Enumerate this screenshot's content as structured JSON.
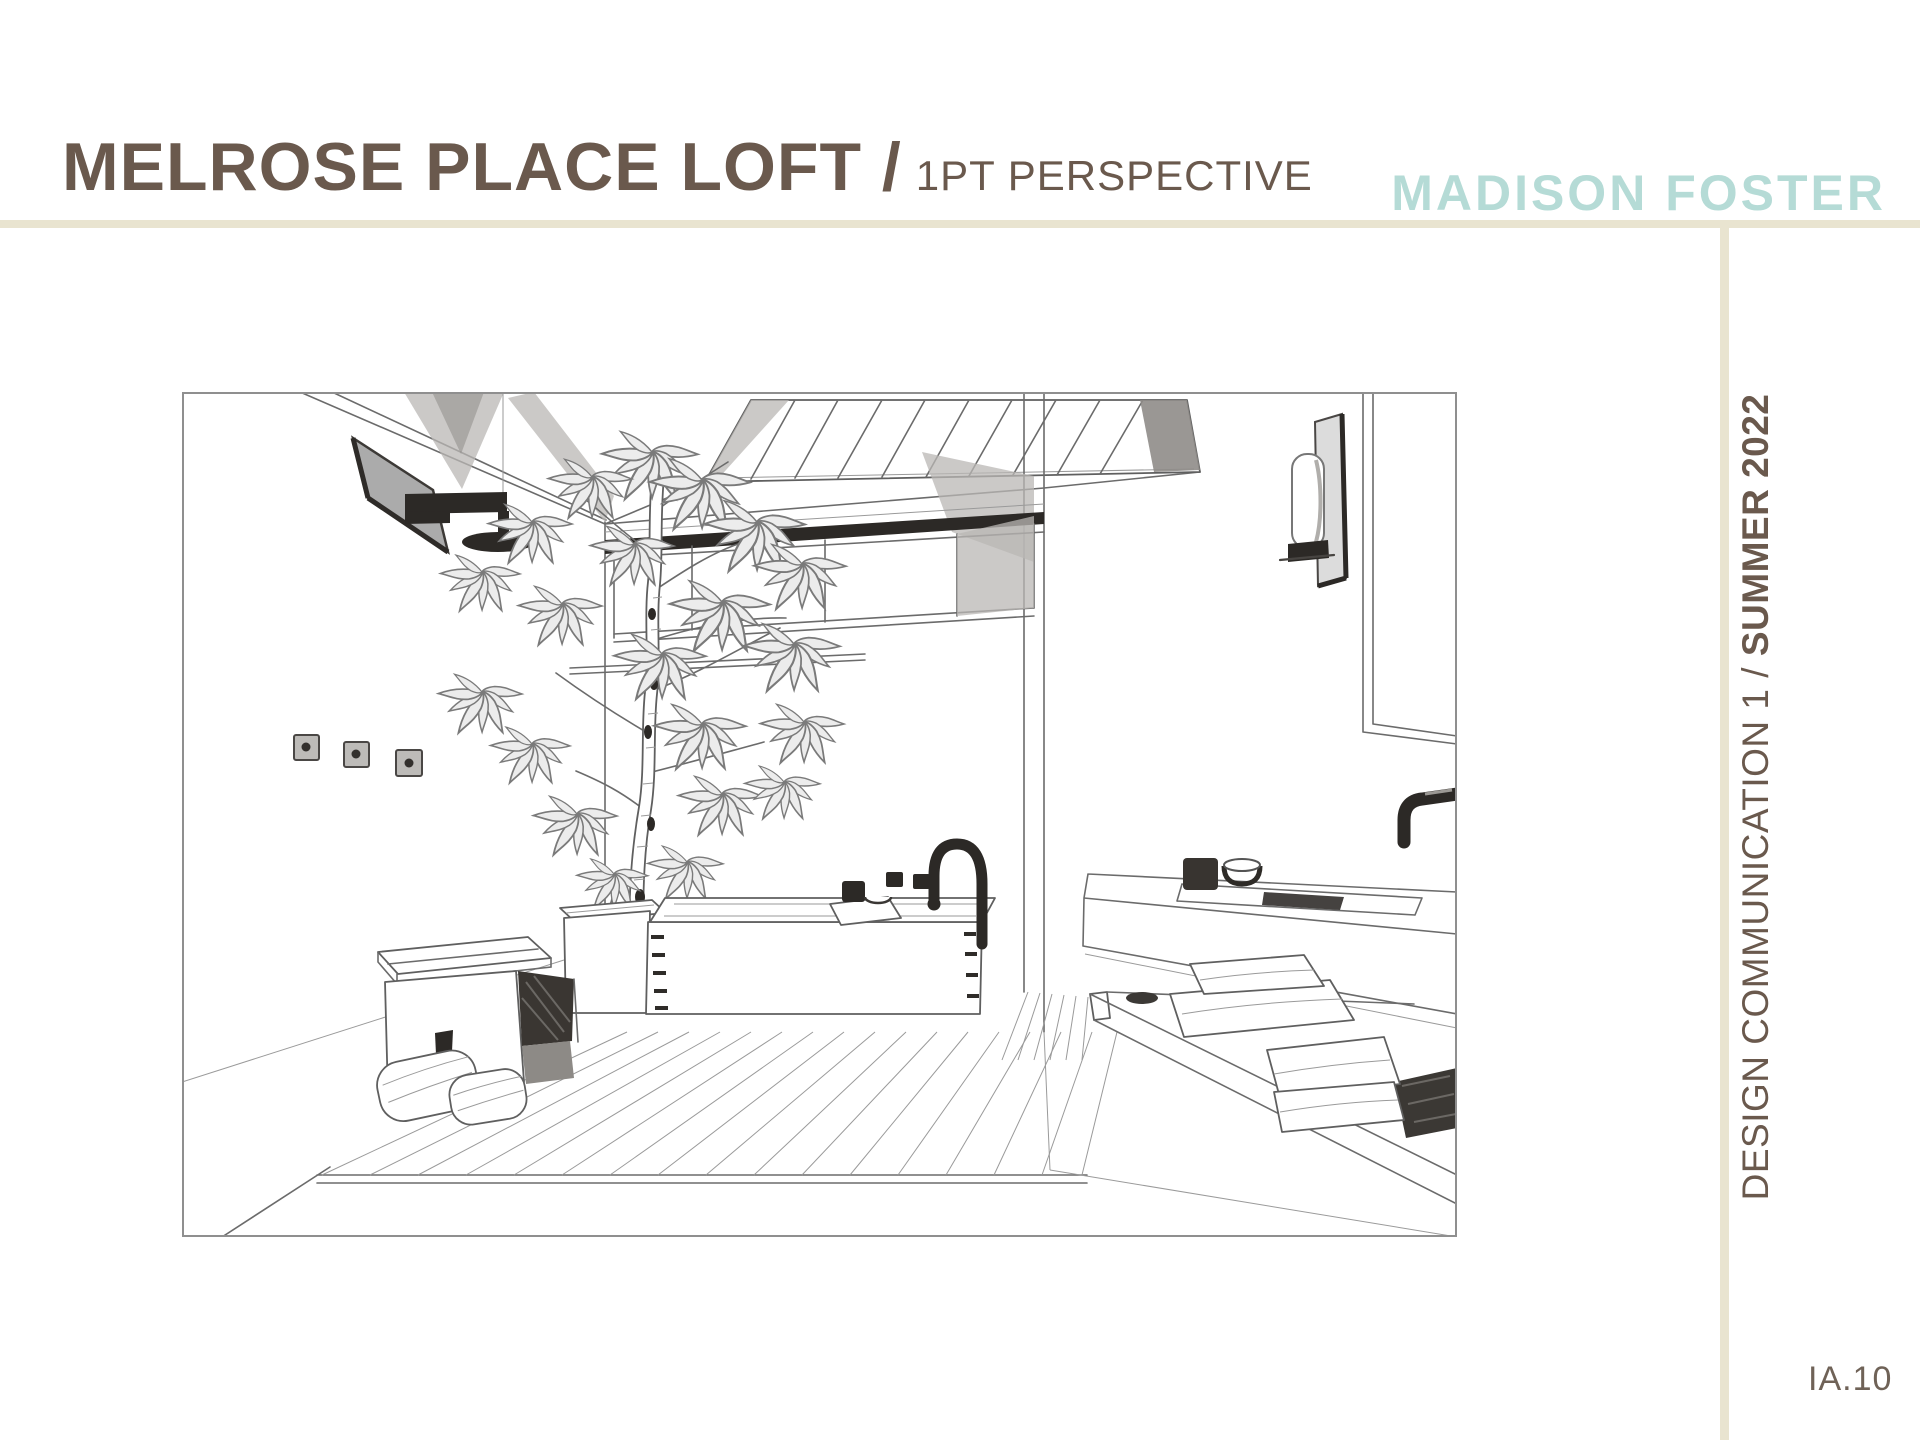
{
  "page": {
    "width": 1920,
    "height": 1440,
    "background": "#ffffff"
  },
  "header": {
    "title": "MELROSE PLACE LOFT /",
    "subtitle": "1PT PERSPECTIVE",
    "brand": "MADISON FOSTER",
    "title_color": "#6a594d",
    "brand_color": "#b5dbd6",
    "rule_color": "#e9e4d0"
  },
  "sidebar": {
    "course_label": "DESIGN COMMUNICATION 1 / ",
    "term_label": "SUMMER 2022",
    "page_number": "IA.10",
    "text_color": "#6a594d"
  },
  "drawing": {
    "medium": "graphite pencil sketch",
    "caption": "One-point perspective sketch of the Melrose Place Loft bathroom",
    "elements": [
      "skylight",
      "clerestory-windows",
      "wall-shelf",
      "shower-head",
      "wall-outlets",
      "indoor-tree",
      "planter",
      "wooden-soaking-tub",
      "gooseneck-tub-faucet",
      "tub-controls",
      "bath-tray",
      "wood-stool",
      "rolled-towels",
      "slatted-deck-floor",
      "floating-vanity",
      "sink-basin",
      "wall-mounted-faucet",
      "toiletries",
      "mirror",
      "wall-sconce",
      "towel-bench",
      "folded-towels"
    ]
  }
}
